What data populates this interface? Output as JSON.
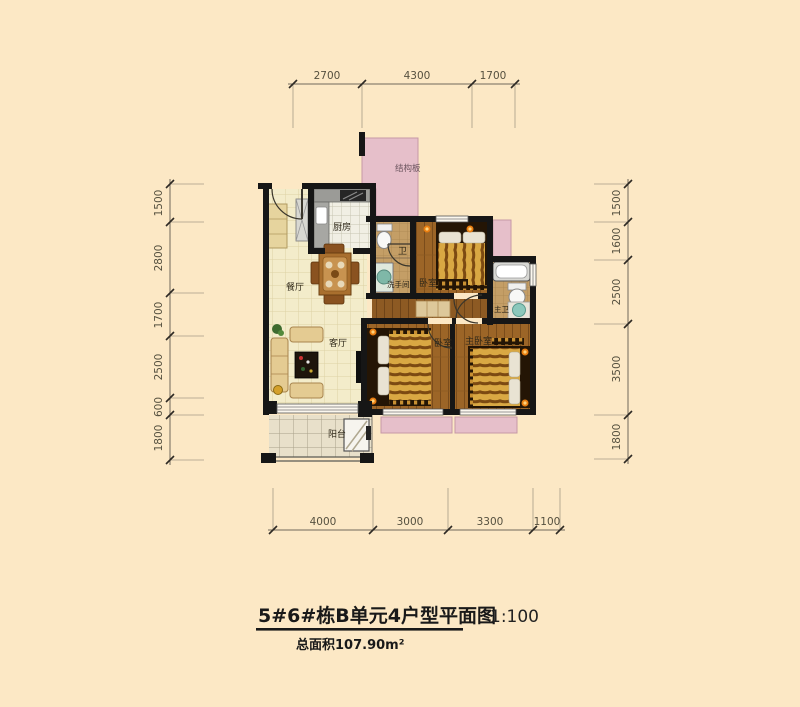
{
  "title": {
    "main": "5#6#栋B单元4户型平面图",
    "scale": "1:100",
    "area": "总面积107.90m²"
  },
  "dimensions": {
    "top": [
      "2700",
      "4300",
      "1700"
    ],
    "bottom": [
      "4000",
      "3000",
      "3300",
      "1100"
    ],
    "left": [
      "1500",
      "2800",
      "1700",
      "2500",
      "600",
      "1800"
    ],
    "right": [
      "1500",
      "1600",
      "2500",
      "3500",
      "1800"
    ]
  },
  "rooms": {
    "kitchen": "厨房",
    "dining": "餐厅",
    "living": "客厅",
    "balcony": "阳台",
    "toilet": "卫",
    "washroom": "洗手间",
    "bedroom_top": "卧室",
    "bedroom_mid": "卧室",
    "master_bedroom": "主卧室",
    "master_bath": "主卫",
    "structural_slab": "结构板"
  },
  "colors": {
    "background": "#fce8c5",
    "slab_pink": "#e6bfca",
    "wall": "#161616",
    "wood_floor": "#9c6527",
    "tile_floor": "#f3ecca",
    "duvet_gold": "#d9a843"
  }
}
